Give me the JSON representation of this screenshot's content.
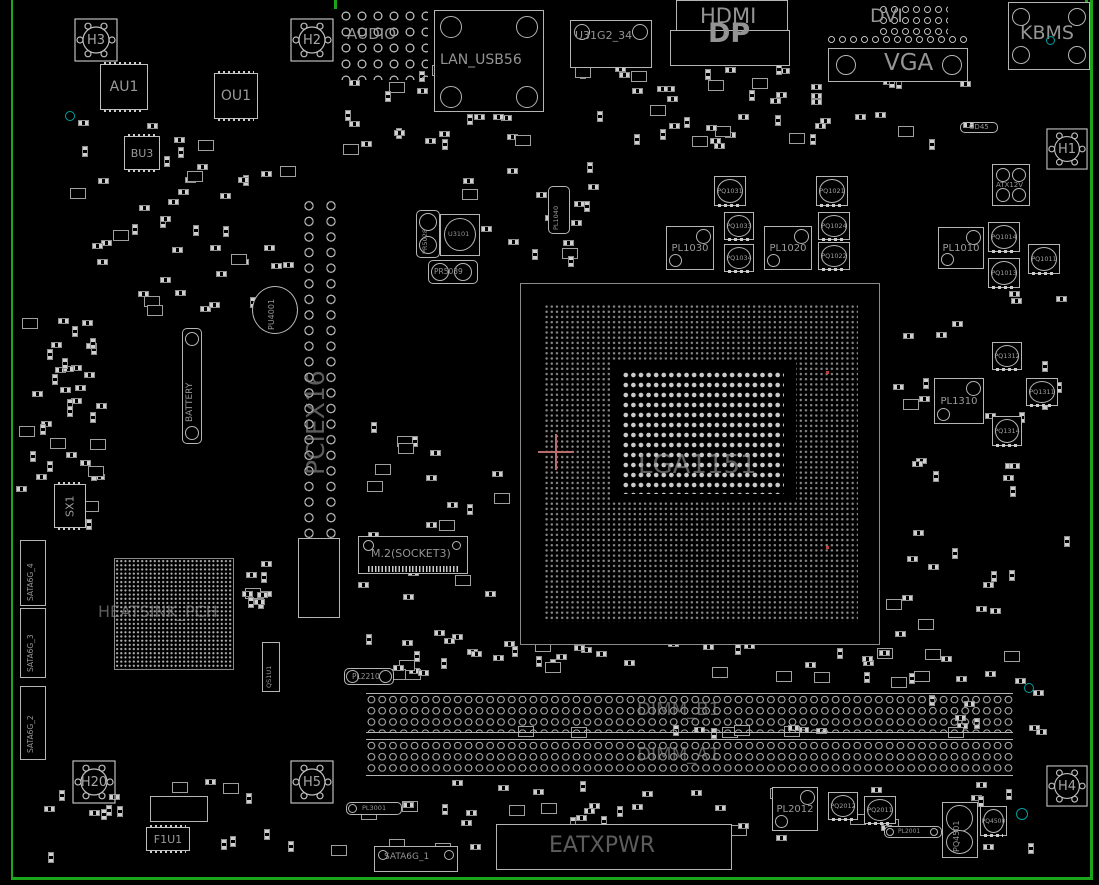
{
  "colors": {
    "background": "#000000",
    "board_outline": "#1aa51a",
    "silkscreen": "#b5b5b5",
    "label_text": "#949494",
    "test_point_teal": "#00a0a0",
    "crosshair_pink": "#b66d6d"
  },
  "io_connectors": {
    "audio": "AUDIO",
    "lan_usb": "LAN_USB56",
    "usb31_34": "U31G2_34",
    "hdmi": "HDMI",
    "dp": "DP",
    "dvi": "DVI",
    "vga": "VGA",
    "kbms": "KBMS"
  },
  "mount_holes": {
    "h1": "H1",
    "h2": "H2",
    "h3": "H3",
    "h4": "H4",
    "h5": "H5",
    "h20": "H20"
  },
  "sockets": {
    "cpu": "LGA1151",
    "pcie_slot": "PCIEX16",
    "m2": "M.2(SOCKET3)",
    "dimm_b1": "DIMM_B1",
    "dimm_a1": "DIMM_A1",
    "battery": "BATTERY"
  },
  "power": {
    "eatxpwr": "EATXPWR",
    "atx12v": "ATX12V"
  },
  "storage": {
    "sata6g_1": "SATA6G_1",
    "sata6g_2": "SATA6G_2",
    "sata6g_3": "SATA6G_3",
    "sata6g_4": "SATA6G_4"
  },
  "chips": {
    "au1": "AU1",
    "ou1": "OU1",
    "bu3": "BU3",
    "sx1": "SX1",
    "f1u1": "F1U1",
    "u3101": "U3101",
    "qs1u1": "QS1U1",
    "pch_heatsink": "HEATSINK_PCH",
    "pu4001": "PU4001",
    "gd45": "GD45"
  },
  "inductors": {
    "pl1010": "PL1010",
    "pl1020": "PL1020",
    "pl1030": "PL1030",
    "pl1040": "PL1040",
    "pl1310": "PL1310",
    "pl2001": "PL2001",
    "pl2012": "PL2012",
    "pl2210": "PL2210",
    "pl3001": "PL3001"
  },
  "mosfets": {
    "pq1011": "PQ1011",
    "pq1013": "PQ1013",
    "pq1014": "PQ1014",
    "pq1021": "PQ1021",
    "pq1022": "PQ1022",
    "pq1024": "PQ1024",
    "pq1031": "PQ1031",
    "pq1033": "PQ1033",
    "pq1034": "PQ1034",
    "pq1311": "PQ1311",
    "pq1312": "PQ1312",
    "pq1314": "PQ1314",
    "pq2011": "PQ2011",
    "pq2012": "PQ2012",
    "pq4500": "PQ4500",
    "pq4501": "PQ4501"
  },
  "regulators": {
    "pr5028": "PR5028",
    "pr5039": "PR5039"
  }
}
